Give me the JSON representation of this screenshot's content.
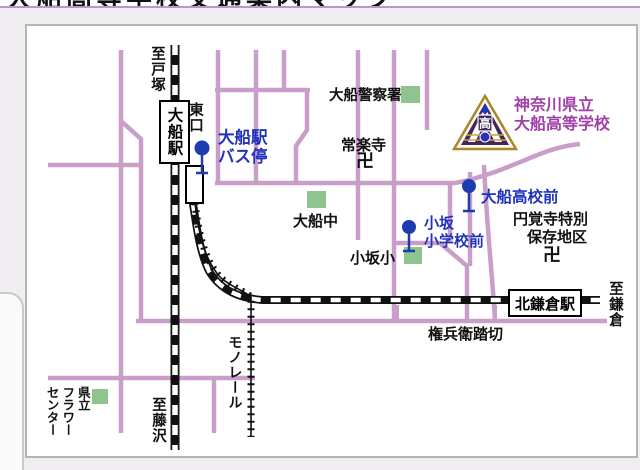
{
  "header": {
    "clipped_title": "大船高等学校交通案内マップ"
  },
  "school": {
    "name_line1": "神奈川県立",
    "name_line2": "大船高等学校",
    "emblem_char": "高"
  },
  "stations": {
    "ofuna": "大船駅",
    "kita_kamakura": "北鎌倉駅",
    "east_exit": "東口"
  },
  "bus_stops": {
    "ofuna_line1": "大船駅",
    "ofuna_line2": "バス停",
    "school_front": "大船高校前",
    "kosaka_line1": "小坂",
    "kosaka_line2": "小学校前"
  },
  "landmarks": {
    "police": "大船警察署",
    "joraku_temple": "常楽寺",
    "temple_mark1": "卍",
    "ofuna_junior_high": "大船中",
    "kosaka_elementary": "小坂小",
    "engakuji_line1": "円覚寺特別",
    "engakuji_line2": "保存地区",
    "temple_mark2": "卍",
    "gonbei_crossing": "権兵衛踏切",
    "flower_center_col1": "県立",
    "flower_center_col2": "フラワー",
    "flower_center_col3": "センター"
  },
  "directions": {
    "to_totsuka": "至戸塚",
    "to_fujisawa": "至藤沢",
    "to_kamakura": "至鎌倉"
  },
  "transit": {
    "monorail": "モノレール"
  },
  "colors": {
    "road": "#c99fc9",
    "railway": "#111111",
    "bus_stop_blue": "#1d3cb0",
    "label_blue": "#2233bb",
    "school_purple": "#a13fa8",
    "landmark_green": "#8fc48f",
    "strip_border": "#b49aca"
  }
}
